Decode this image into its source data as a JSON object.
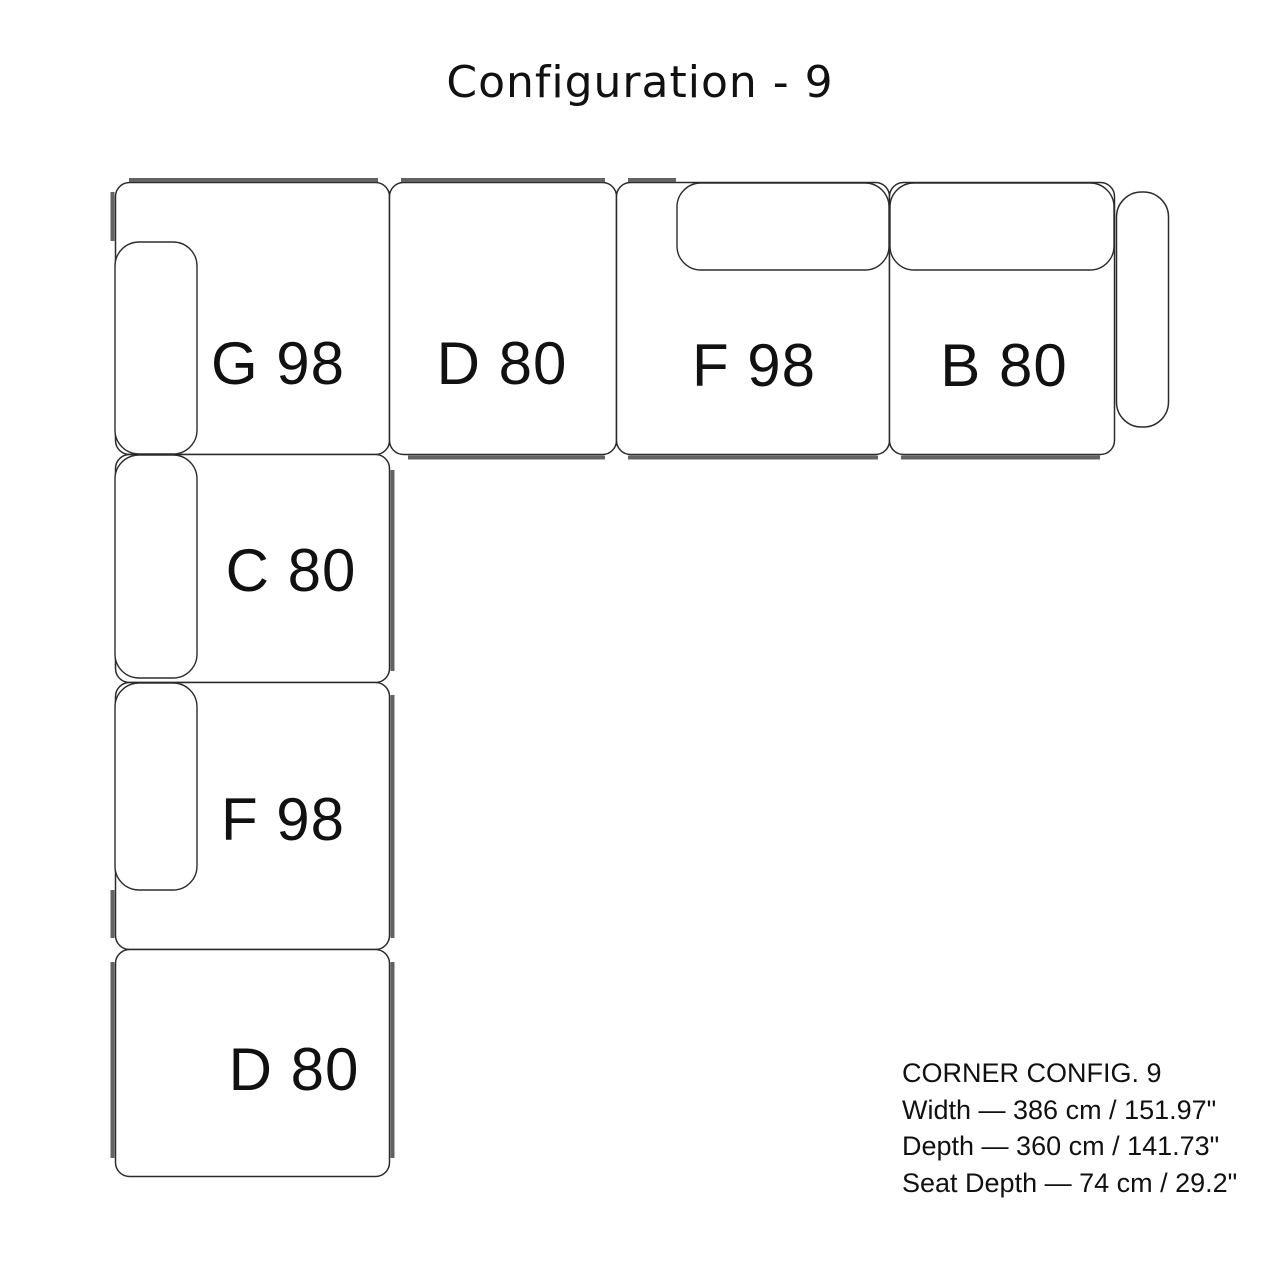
{
  "title": "Configuration - 9",
  "modules": {
    "g98": {
      "label": "G 98"
    },
    "d80_top": {
      "label": "D 80"
    },
    "f98_top": {
      "label": "F 98"
    },
    "b80": {
      "label": "B 80"
    },
    "c80": {
      "label": "C 80"
    },
    "f98_left": {
      "label": "F 98"
    },
    "d80_bottom": {
      "label": "D 80"
    }
  },
  "specs": {
    "heading": "CORNER CONFIG. 9",
    "width": "Width — 386 cm / 151.97\"",
    "depth": "Depth — 360 cm / 141.73\"",
    "seat_depth": "Seat Depth — 74 cm / 29.2\""
  },
  "colors": {
    "outline": "#2b2b2b",
    "rail": "#636363",
    "text": "#111111",
    "background": "#ffffff"
  }
}
